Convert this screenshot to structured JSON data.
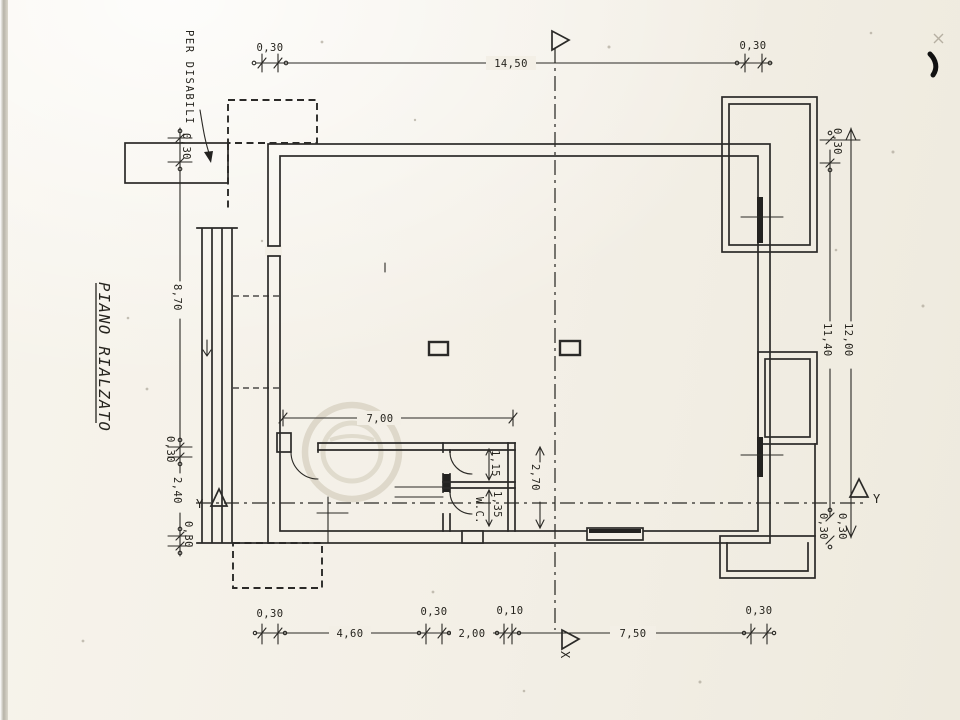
{
  "drawing": {
    "floor_title": "PIANO RIALZATO",
    "accessibility_note": "PER DISABILI",
    "room_labels": {
      "wc": "W.C."
    },
    "axis_markers": {
      "x_bottom": "X",
      "y_right": "Y",
      "y_left": "Y"
    },
    "dimensions": {
      "top_wall_left": "0,30",
      "top_width": "14,50",
      "top_wall_right": "0,30",
      "left_wall_top": "0,30",
      "left_depth": "8,70",
      "left_wall_mid": "0,30",
      "left_stairs": "2,40",
      "left_wall_bottom": "0,30",
      "right_wall_top": "0,30",
      "right_height_outer": "12,00",
      "right_height_inner": "11,40",
      "right_wall_bottom_inner": "0,30",
      "right_wall_bottom_outer": "0,30",
      "bottom_wall_left": "0,30",
      "bottom_span_left": "4,60",
      "bottom_wall_mid": "0,30",
      "bottom_opening": "2,00",
      "bottom_step": "0,10",
      "bottom_span_right": "7,50",
      "bottom_wall_right": "0,30",
      "hall_width": "7,00",
      "hall_depth": "2,70",
      "antibagno_depth": "1,15",
      "wc_depth": "1,35"
    },
    "colors": {
      "ink": "#2b2a28",
      "paper": "#f3efe6"
    }
  }
}
